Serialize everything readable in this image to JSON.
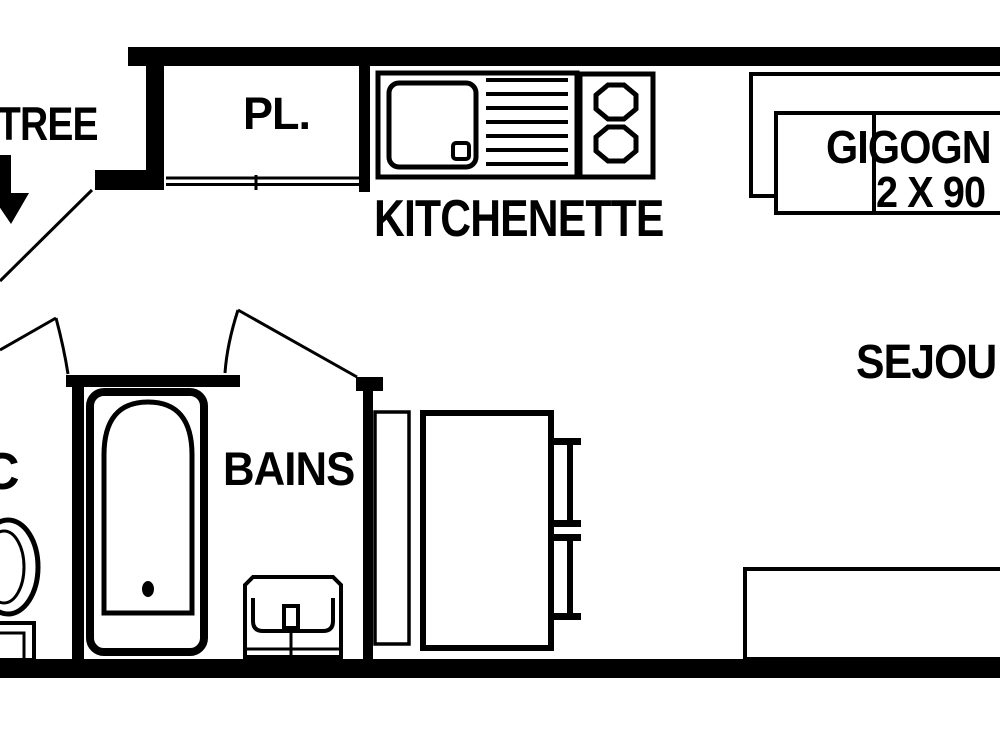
{
  "colors": {
    "ink": "#000000",
    "background": "#ffffff"
  },
  "labels": {
    "entrance": "TREE",
    "closet": "PL.",
    "kitchenette": "KITCHENETTE",
    "trundle_beds": "GIGOGN",
    "trundle_beds_size": "2 X 90",
    "living_room": "SEJOU",
    "bathroom": "BAINS",
    "wc": "C"
  },
  "symbols": [
    "entrance-arrow-icon",
    "entrance-door-swing",
    "closet-sliding-doors",
    "kitchen-sink-icon",
    "cooktop-icon",
    "trundle-beds-icon",
    "wc-door-swing",
    "bathroom-door-swing",
    "bathtub-icon",
    "toilet-icon",
    "washbasin-icon",
    "cabinet-icon",
    "table-icon",
    "chair-icon",
    "sofa-icon"
  ]
}
